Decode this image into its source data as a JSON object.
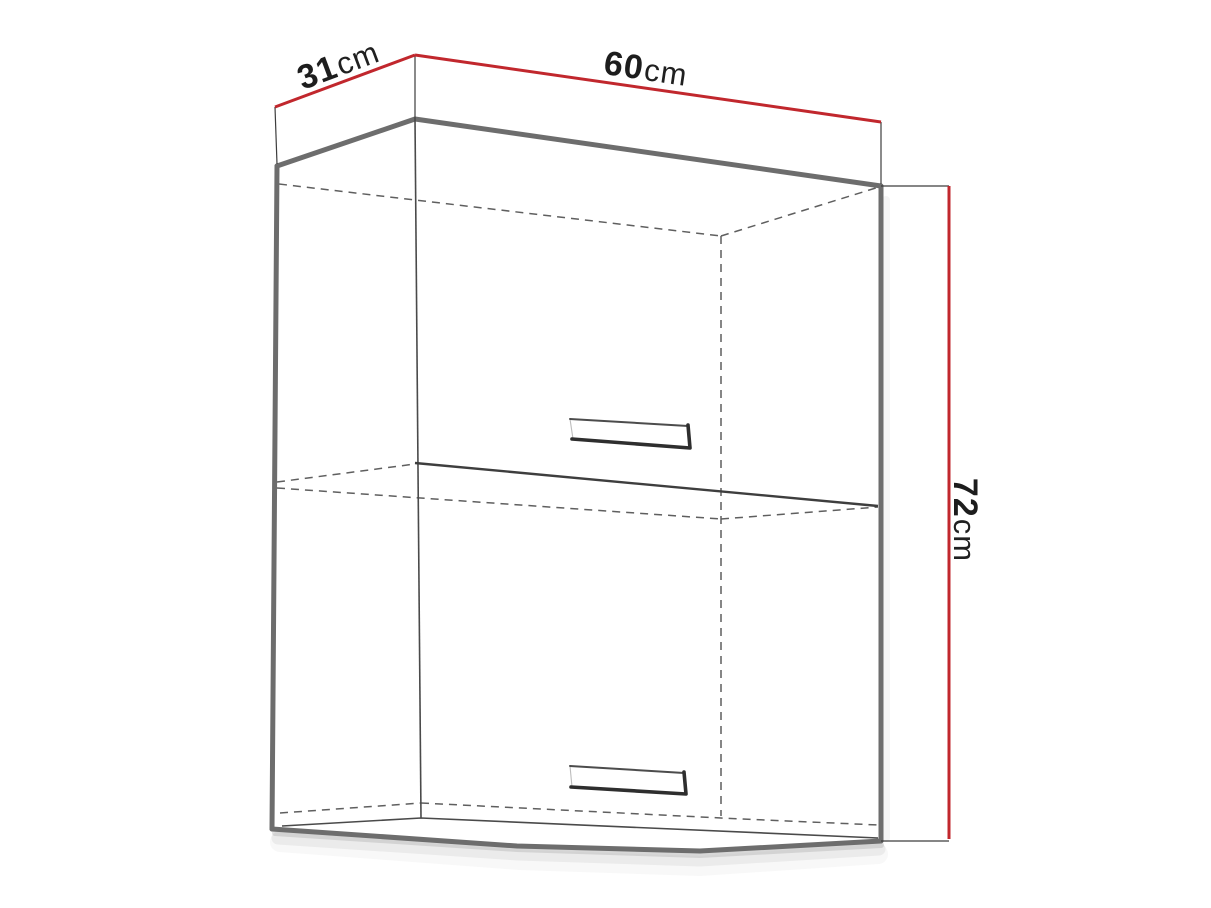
{
  "diagram": {
    "type": "furniture-dimension-drawing",
    "subject": "two-door wall cabinet",
    "dimensions": {
      "depth": {
        "value": "31",
        "unit": "cm"
      },
      "width": {
        "value": "60",
        "unit": "cm"
      },
      "height": {
        "value": "72",
        "unit": "cm"
      }
    },
    "colors": {
      "dimension_line": "#c1272d",
      "label_text": "#1d1d1d",
      "cabinet_edge": "#6d6d6d",
      "hidden_line": "#5f5f5f",
      "background": "#ffffff"
    }
  }
}
